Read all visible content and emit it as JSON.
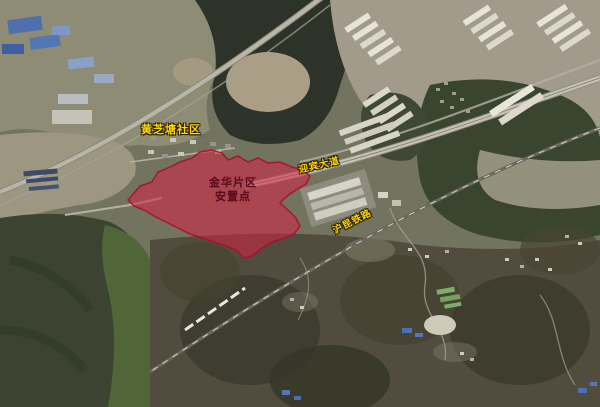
{
  "map": {
    "type": "satellite-imagery",
    "labels": {
      "community": {
        "text": "黄芝塘社区"
      },
      "site": {
        "line1": "金华片区",
        "line2": "安置点"
      },
      "road": {
        "text": "迎宾大道"
      },
      "railway": {
        "text": "沪昆铁路"
      }
    },
    "colors": {
      "overlay_fill": "#d52341",
      "overlay_stroke": "#a90e2c",
      "label_yellow": "#ffd800",
      "site_label_red": "#5c0d1c"
    }
  }
}
